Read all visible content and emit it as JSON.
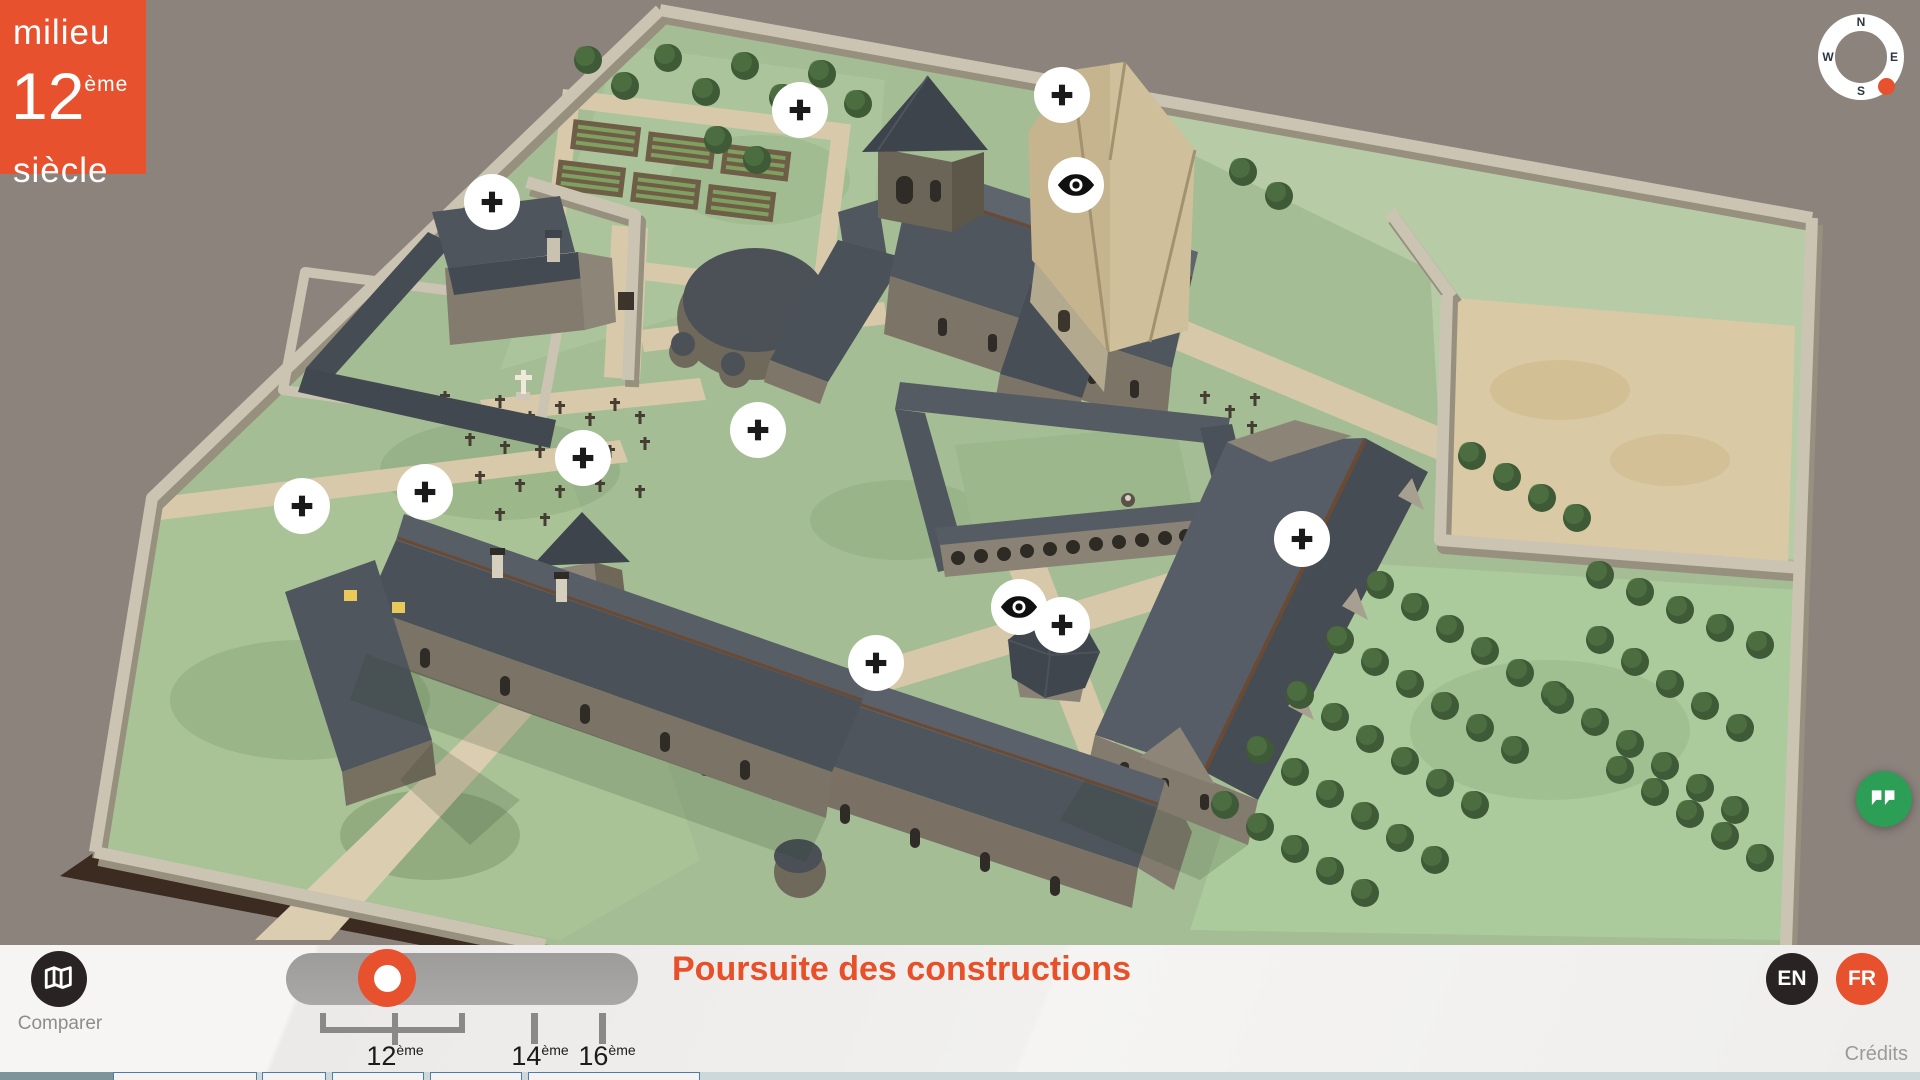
{
  "badge": {
    "prefix": "milieu",
    "century": "12",
    "century_sup": "ème",
    "suffix": "siècle"
  },
  "compass": {
    "north": "N",
    "east": "E",
    "south": "S",
    "west": "W"
  },
  "scene": {
    "markers": [
      {
        "type": "plus",
        "x": 800,
        "y": 110
      },
      {
        "type": "plus",
        "x": 1062,
        "y": 95
      },
      {
        "type": "eye",
        "x": 1076,
        "y": 185
      },
      {
        "type": "plus",
        "x": 492,
        "y": 202
      },
      {
        "type": "plus",
        "x": 758,
        "y": 430
      },
      {
        "type": "plus",
        "x": 583,
        "y": 458
      },
      {
        "type": "plus",
        "x": 425,
        "y": 492
      },
      {
        "type": "plus",
        "x": 302,
        "y": 506
      },
      {
        "type": "plus",
        "x": 1302,
        "y": 539
      },
      {
        "type": "eye",
        "x": 1019,
        "y": 607
      },
      {
        "type": "plus",
        "x": 1062,
        "y": 625
      },
      {
        "type": "plus",
        "x": 876,
        "y": 663
      }
    ]
  },
  "toolbar": {
    "compare_label": "Comparer",
    "title": "Poursuite des constructions",
    "credits_label": "Crédits",
    "languages": [
      {
        "code": "EN"
      },
      {
        "code": "FR"
      }
    ],
    "selected_language": "FR",
    "timeline": {
      "selected": "12ème",
      "periods": [
        {
          "num": "12",
          "sup": "ème"
        },
        {
          "num": "14",
          "sup": "ème"
        },
        {
          "num": "16",
          "sup": "ème"
        }
      ]
    }
  },
  "colors": {
    "accent": "#e8512d",
    "quote_green": "#2d9e55",
    "dark": "#292423"
  }
}
